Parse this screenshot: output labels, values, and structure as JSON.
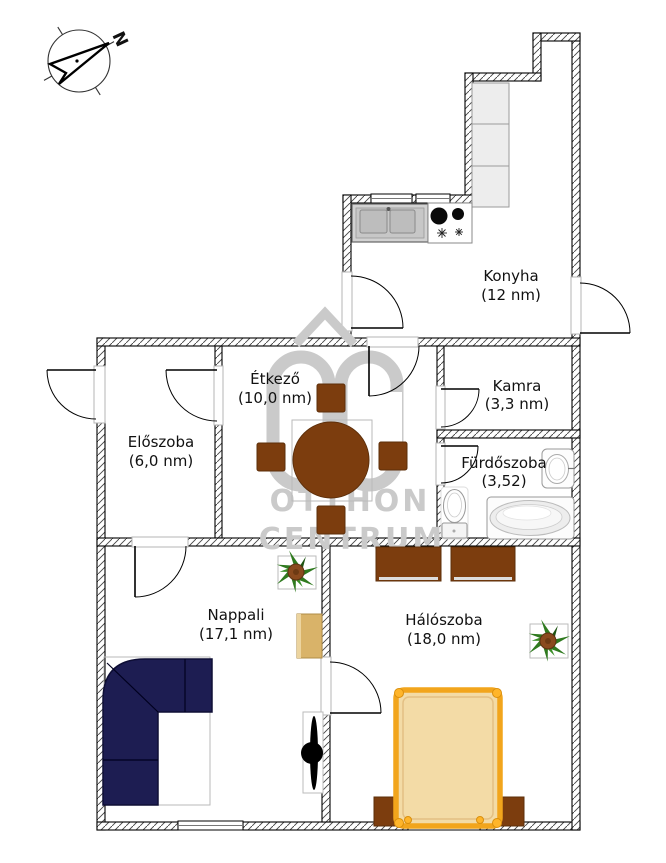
{
  "title": "apartment-floor-plan",
  "compass": {
    "letter": "N"
  },
  "watermark": {
    "brand_top": "OTTHON",
    "brand_bottom": "CENTRUM",
    "logo": "oc-house-logo",
    "color": "#cacaca"
  },
  "rooms": {
    "konyha": {
      "name": "Konyha",
      "area": "(12 nm)"
    },
    "etkezo": {
      "name": "Étkező",
      "area": "(10,0 nm)"
    },
    "kamra": {
      "name": "Kamra",
      "area": "(3,3 nm)"
    },
    "furdoszoba": {
      "name": "Fürdőszoba",
      "area": "(3,52)"
    },
    "eloszoba": {
      "name": "Előszoba",
      "area": "(6,0 nm)"
    },
    "nappali": {
      "name": "Nappali",
      "area": "(17,1 nm)"
    },
    "haloszoba": {
      "name": "Hálószoba",
      "area": "(18,0 nm)"
    }
  },
  "colors": {
    "wall_line": "#222222",
    "furniture_brown": "#7c3d0e",
    "sofa_navy": "#1d1d52",
    "bed_frame_orange": "#f2a51c",
    "bed_fill": "#f3dba6",
    "sideboard_tan": "#d9b369",
    "plant_green": "#2f7a1f",
    "watermark_gray": "#cacaca"
  }
}
